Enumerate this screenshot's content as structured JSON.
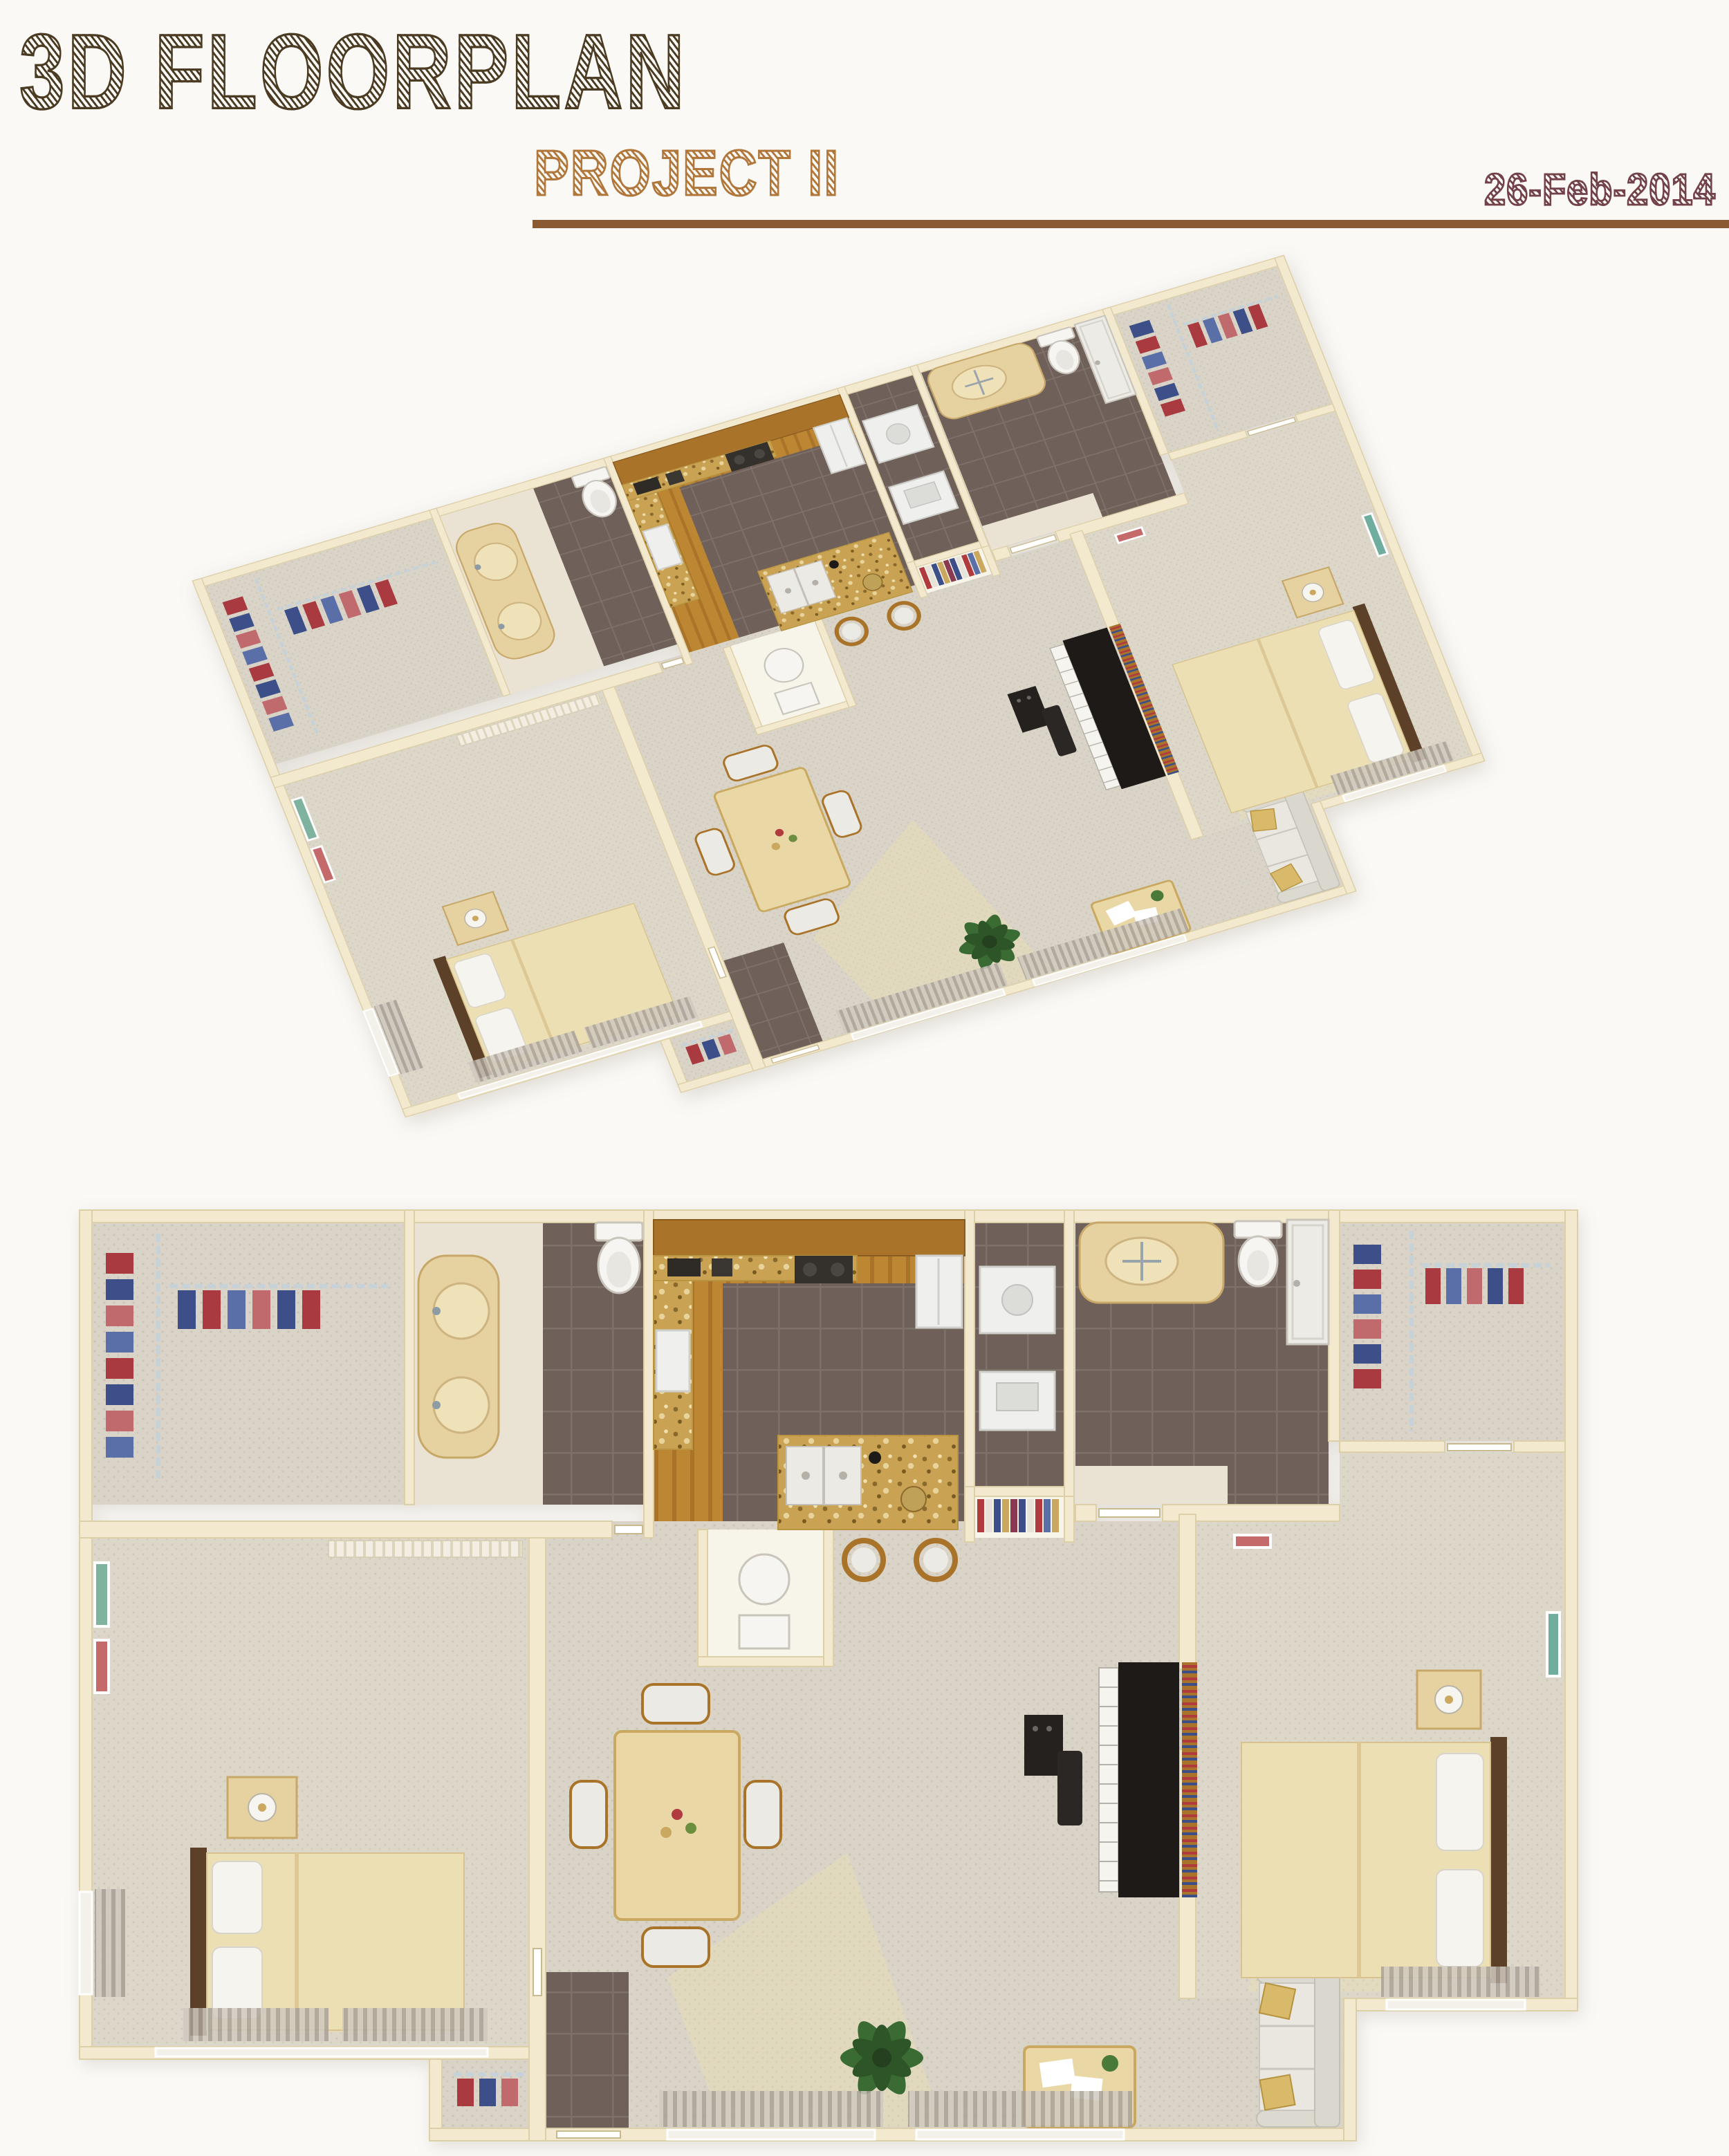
{
  "header": {
    "title": "3D FLOORPLAN",
    "subtitle": "PROJECT II",
    "date": "26-Feb-2014"
  },
  "palette": {
    "title_brown": "#4a3b22",
    "subtitle_orange": "#b0763a",
    "date_maroon": "#734249",
    "rule_brown": "#8a5a33",
    "page_bg": "#faf9f6",
    "wall_cream": "#f3e9cf",
    "carpet_beige": "#d9d4c7",
    "wood_floor": "#bd8633",
    "dark_tile": "#6f6159",
    "granite_gold": "#c9a254"
  },
  "figures": {
    "top": {
      "name": "isometric-3d-floorplan-render"
    },
    "bottom": {
      "name": "top-down-floorplan-render"
    }
  }
}
